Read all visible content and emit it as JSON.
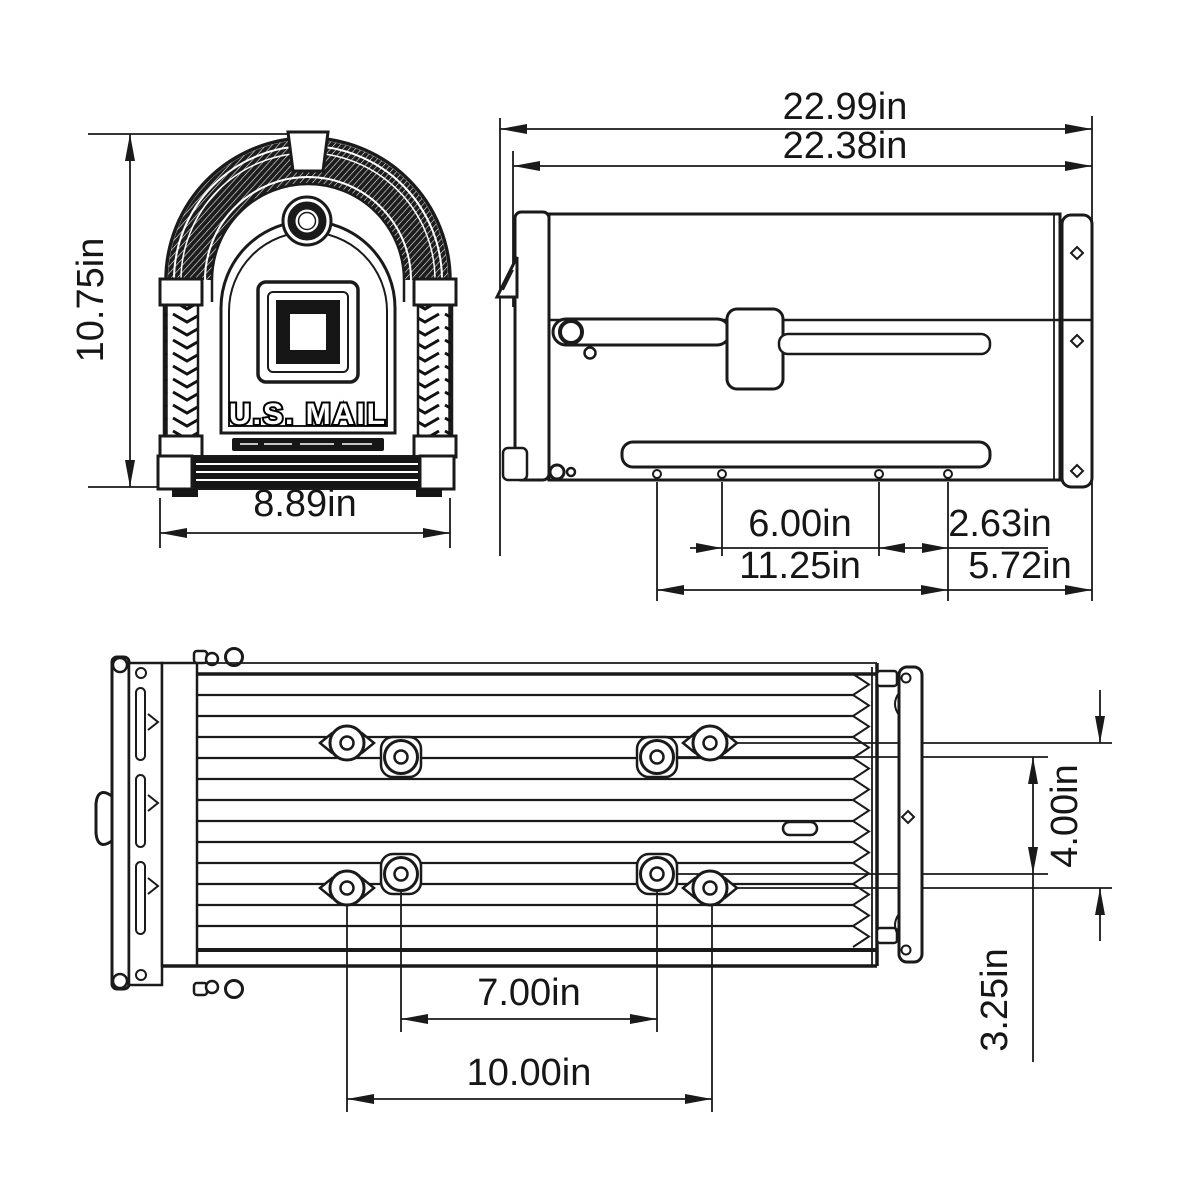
{
  "page": {
    "background_color": "#ffffff",
    "line_color": "#1a1a1a",
    "dark_fill_color": "#161616"
  },
  "front_view": {
    "name": "front-view",
    "height_label": "10.75in",
    "width_label": "8.89in",
    "door_brand_text": "U.S. MAIL"
  },
  "side_view": {
    "name": "side-view",
    "overall_length_label": "22.99in",
    "body_length_label": "22.38in",
    "center_hole_spacing_label": "6.00in",
    "rear_hole_offset_label": "2.63in",
    "mounting_hole_span_label": "11.25in",
    "rear_overhang_label": "5.72in"
  },
  "bottom_view": {
    "name": "bottom-view",
    "inner_hole_spacing_label": "7.00in",
    "outer_hole_spacing_label": "10.00in",
    "outer_row_spacing_label": "4.00in",
    "inner_row_spacing_label": "3.25in"
  }
}
